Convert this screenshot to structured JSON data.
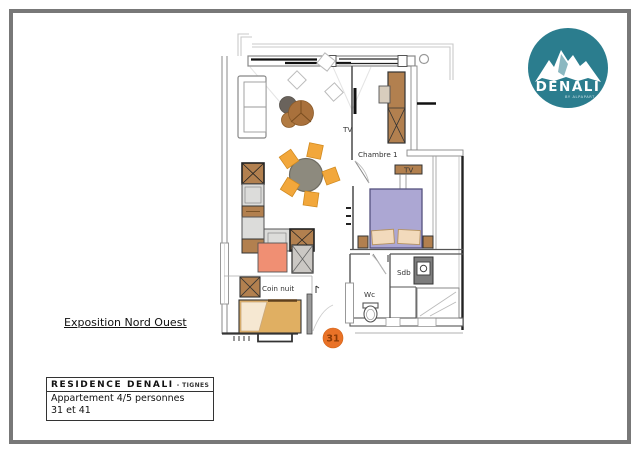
{
  "logo": {
    "brand": "DENALI",
    "tagline": "BY ALPAPART",
    "color": "#2B7D8E"
  },
  "annotations": {
    "exposition": "Exposition Nord Ouest"
  },
  "title_block": {
    "residence": "RESIDENCE DENALI",
    "location": "- TIGNES",
    "apartment_type": "Appartement 4/5 personnes",
    "apartment_numbers": "31 et 41"
  },
  "plan": {
    "labels": {
      "tv_living": "TV",
      "chambre_1": "Chambre 1",
      "tv_chambre": "TV",
      "sdb": "Sdb",
      "wc": "Wc",
      "coin_nuit": "Coin nuit",
      "door_number": "31"
    },
    "colors": {
      "chair_orange": "#F2A73B",
      "wood_brown": "#B2804F",
      "bed_purple": "#ACA7D3",
      "bed_tan": "#E0AF62",
      "pillow_beige": "#F2DABC",
      "salmon": "#F08F73",
      "badge_orange": "#E97227",
      "table_gray": "#8D8A7E"
    }
  }
}
